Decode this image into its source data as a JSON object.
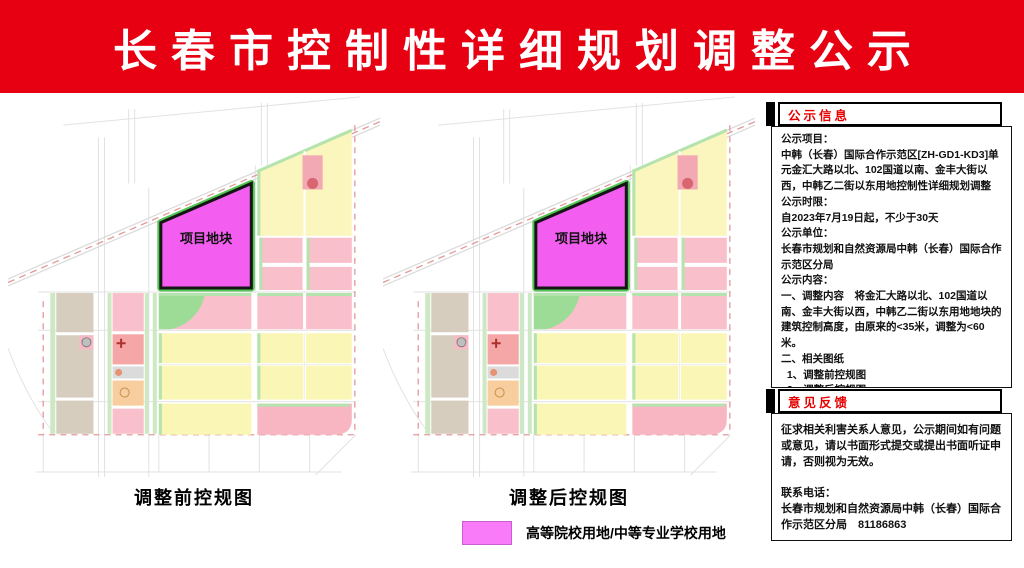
{
  "banner": {
    "title": "长春市控制性详细规划调整公示",
    "bg_color": "#e60012",
    "text_color": "#ffffff"
  },
  "maps": {
    "plot_label": "项目地块",
    "plot_fill": "#f35ef1",
    "before_caption": "调整前控规图",
    "after_caption": "调整后控规图"
  },
  "legend": {
    "swatch_color": "#fa7bfa",
    "label": "高等院校用地/中等专业学校用地"
  },
  "info_panel": {
    "header": "公示信息",
    "header_color": "#e60000",
    "lines": [
      "公示项目：",
      "中韩（长春）国际合作示范区[ZH-GD1-KD3]单元金汇大路以北、102国道以南、金丰大街以西，中韩乙二街以东用地控制性详细规划调整",
      "公示时限：",
      "自2023年7月19日起，不少于30天",
      "公示单位：",
      "长春市规划和自然资源局中韩（长春）国际合作示范区分局",
      "公示内容：",
      "一、调整内容　将金汇大路以北、102国道以南、金丰大街以西，中韩乙二街以东用地地块的建筑控制高度，由原来的<35米，调整为<60米。",
      "二、相关图纸",
      "  1、调整前控规图",
      "  2、调整后控规图"
    ]
  },
  "feedback_panel": {
    "header": "意见反馈",
    "header_color": "#e60000",
    "paragraphs": [
      "征求相关利害关系人意见，公示期间如有问题或意见，请以书面形式提交或提出书面听证申请，否则视为无效。"
    ],
    "contact_label": "联系电话：",
    "contact_value": "长春市规划和自然资源局中韩（长春）国际合作示范区分局　81186863"
  }
}
